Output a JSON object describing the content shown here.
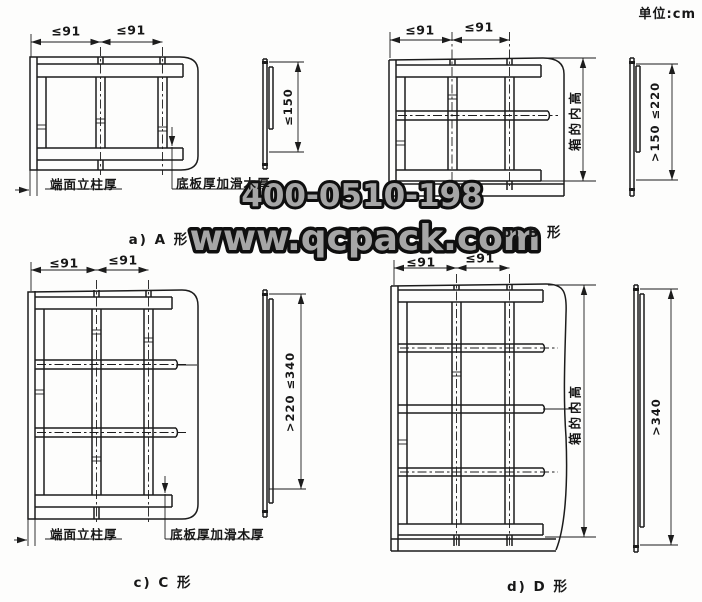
{
  "page": {
    "unit_label": "单位:cm",
    "background": "#fdfdfc",
    "line_color": "#1c1c1c"
  },
  "watermark": {
    "phone": "400-0510-198",
    "website": "www.qcpack.com",
    "fill": "#a6a6a6",
    "outline": "#0f0f0f"
  },
  "diagrams": {
    "a": {
      "caption": "a) A 形",
      "top_dims": {
        "left": "≤91",
        "right": "≤91"
      },
      "side_dim": "≤150",
      "callouts": {
        "post": "端面立柱厚",
        "bottom": "底板厚加滑木厚"
      }
    },
    "b": {
      "caption": "b) B 形",
      "top_dims": {
        "left": "≤91",
        "right": "≤91"
      },
      "side_dim": ">150 ≤220",
      "height_label": "箱的内高"
    },
    "c": {
      "caption": "c) C 形",
      "top_dims": {
        "left": "≤91",
        "right": "≤91"
      },
      "side_dim": ">220 ≤340",
      "callouts": {
        "post": "端面立柱厚",
        "bottom": "底板厚加滑木厚"
      }
    },
    "d": {
      "caption": "d) D 形",
      "top_dims": {
        "left": "≤91",
        "right": "≤91"
      },
      "side_dim": ">340",
      "height_label": "箱的内高"
    }
  }
}
